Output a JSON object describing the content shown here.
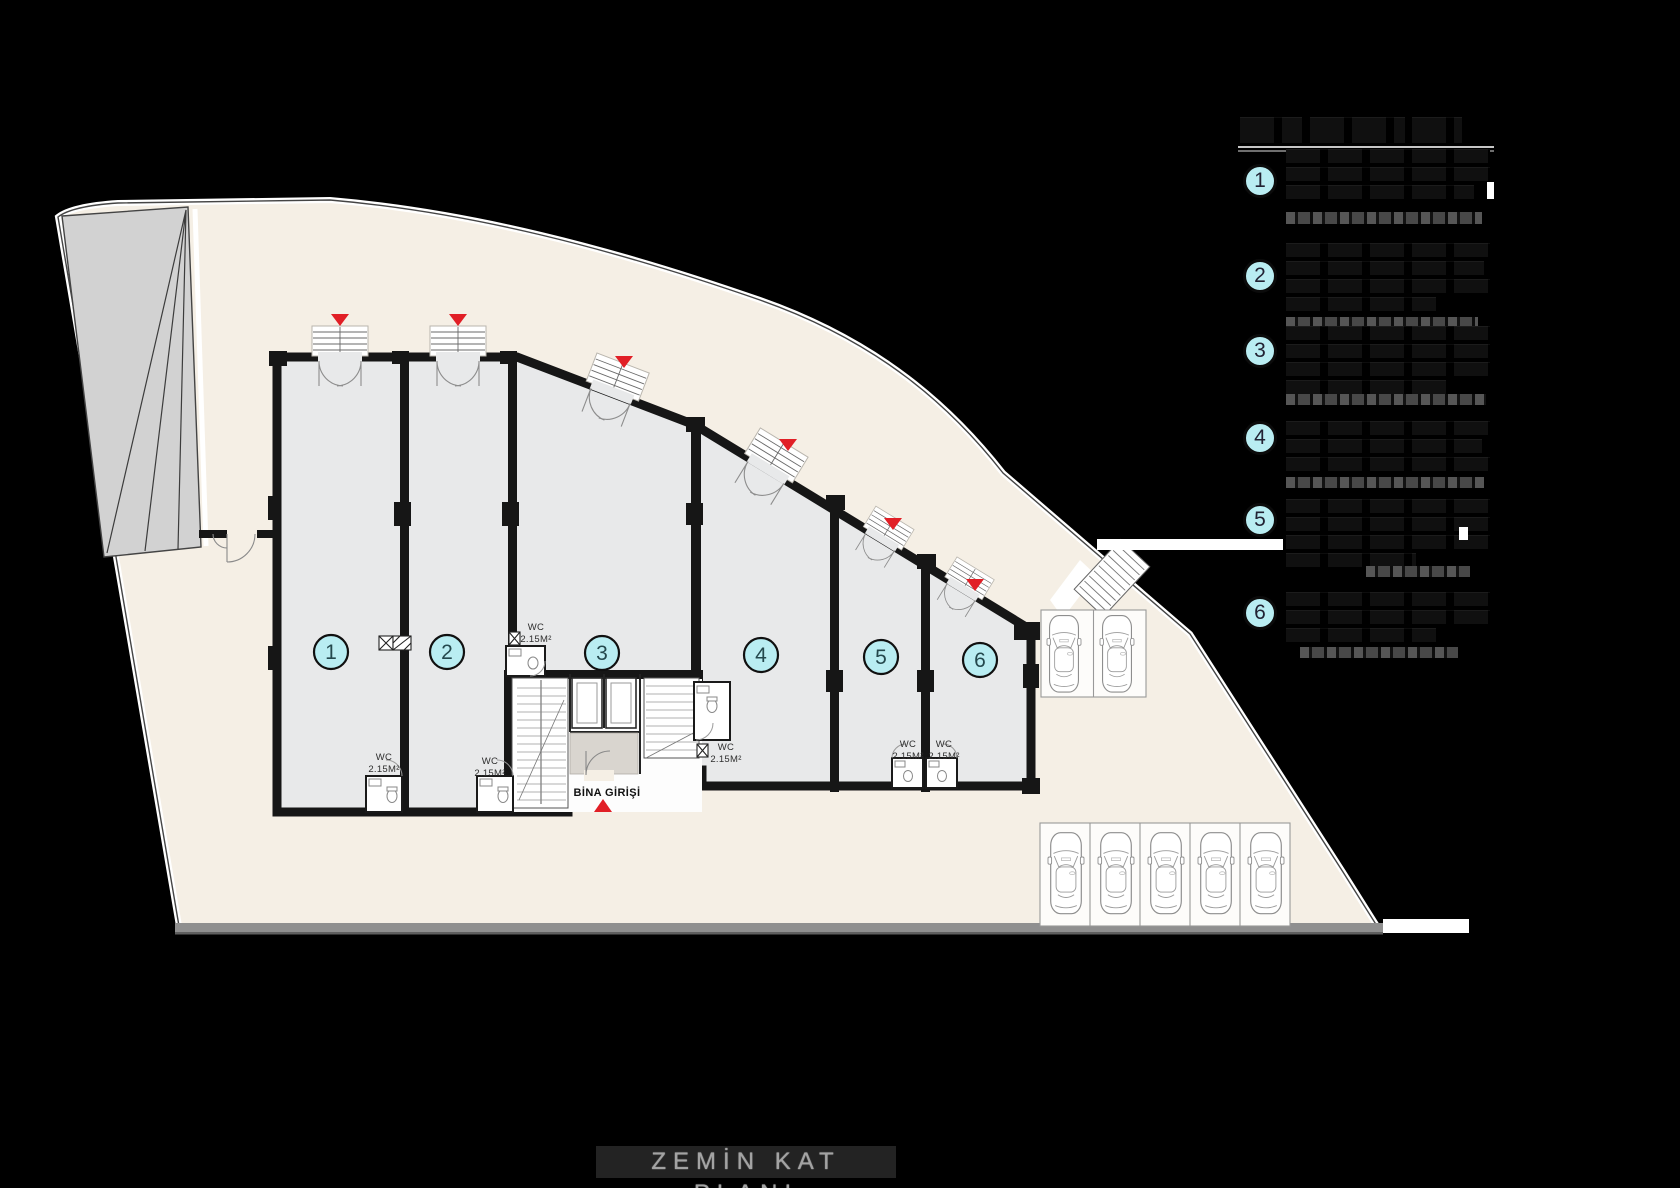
{
  "page": {
    "width": 1680,
    "height": 1188,
    "background": "#000000"
  },
  "plan": {
    "units": [
      {
        "number": "1"
      },
      {
        "number": "2"
      },
      {
        "number": "3"
      },
      {
        "number": "4"
      },
      {
        "number": "5"
      },
      {
        "number": "6"
      }
    ],
    "wc_label": {
      "line1": "WC",
      "line2": "2.15M²"
    },
    "entrance_label": "BİNA GİRİŞİ",
    "colors": {
      "site": "#f5efe5",
      "floor": "#e8e9ea",
      "wall": "#161616",
      "unit_badge": "#b9edf2",
      "arrow": "#e11f26",
      "road": "#8f8f8f"
    }
  },
  "legend": {
    "items": [
      {
        "number": "1"
      },
      {
        "number": "2"
      },
      {
        "number": "3"
      },
      {
        "number": "4"
      },
      {
        "number": "5"
      },
      {
        "number": "6"
      }
    ]
  },
  "footer": {
    "title": "ZEMİN KAT PLANI"
  }
}
